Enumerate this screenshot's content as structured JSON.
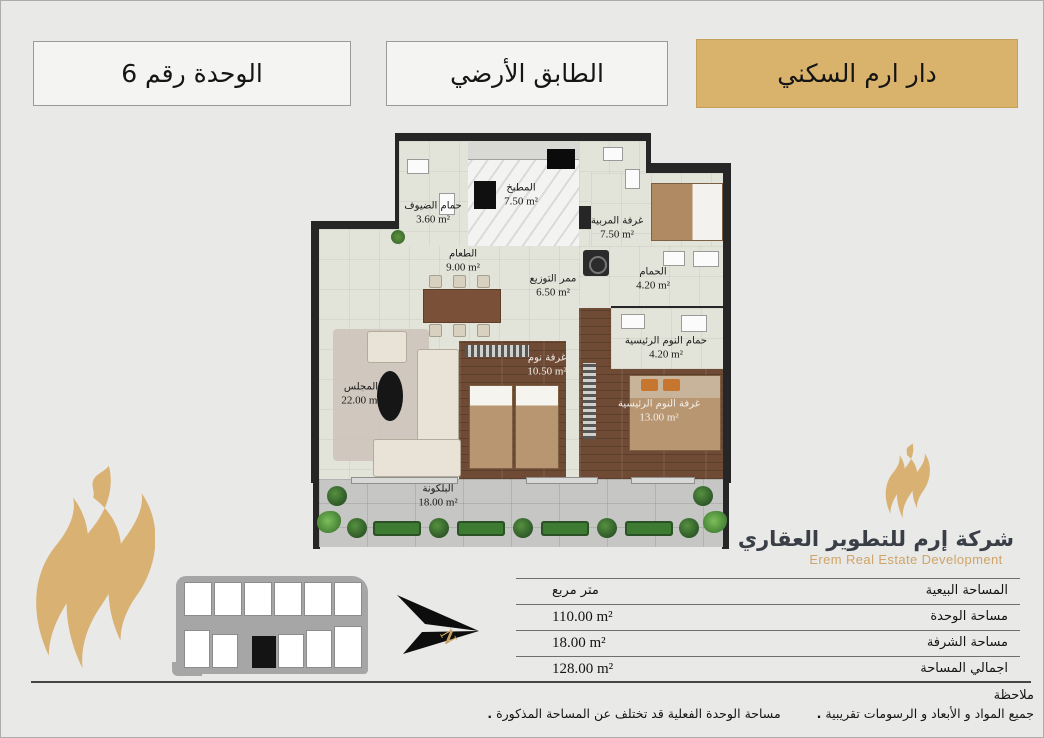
{
  "header": {
    "project": "دار ارم السكني",
    "floor": "الطابق الأرضي",
    "unit": "الوحدة رقم 6"
  },
  "plan": {
    "rooms": [
      {
        "id": "guest-bath",
        "name": "حمام الضيوف",
        "area": "3.60 m²"
      },
      {
        "id": "kitchen",
        "name": "المطبخ",
        "area": "7.50 m²"
      },
      {
        "id": "maid-room",
        "name": "غرفة المربية",
        "area": "7.50 m²"
      },
      {
        "id": "dining",
        "name": "الطعام",
        "area": "9.00 m²"
      },
      {
        "id": "corridor",
        "name": "ممر التوزيع",
        "area": "6.50 m²"
      },
      {
        "id": "bathroom",
        "name": "الحمام",
        "area": "4.20 m²"
      },
      {
        "id": "master-bath",
        "name": "حمام النوم الرئيسية",
        "area": "4.20 m²"
      },
      {
        "id": "majlis",
        "name": "المجلس",
        "area": "22.00 m²"
      },
      {
        "id": "bedroom",
        "name": "غرفة نوم",
        "area": "10.50 m²"
      },
      {
        "id": "master-bedroom",
        "name": "غرفة النوم الرئيسية",
        "area": "13.00 m²"
      },
      {
        "id": "balcony",
        "name": "البلكونة",
        "area": "18.00 m²"
      }
    ]
  },
  "logo": {
    "name_ar": "شركة إرم للتطوير العقاري",
    "name_en": "Erem Real Estate Development"
  },
  "compass": {
    "letter": "N"
  },
  "table": {
    "rows": [
      {
        "label": "المساحة البيعية",
        "value": "متر مربع"
      },
      {
        "label": "مساحة الوحدة",
        "value": "110.00 m²"
      },
      {
        "label": "مساحة الشرفة",
        "value": "18.00 m²"
      },
      {
        "label": "اجمالي المساحة",
        "value": "128.00 m²"
      }
    ]
  },
  "notes": {
    "title": "ملاحظة",
    "bullet": ".",
    "items": [
      "جميع المواد و الأبعاد و الرسومات تقريبية",
      "مساحة الوحدة الفعلية قد تختلف عن المساحة المذكورة"
    ]
  },
  "colors": {
    "gold": "#d9b26c",
    "gold_text": "#cfa468",
    "wall": "#262626",
    "floor": "#e3e4d9",
    "wood": "#6f4b36",
    "page_bg": "#e9e9e8"
  }
}
